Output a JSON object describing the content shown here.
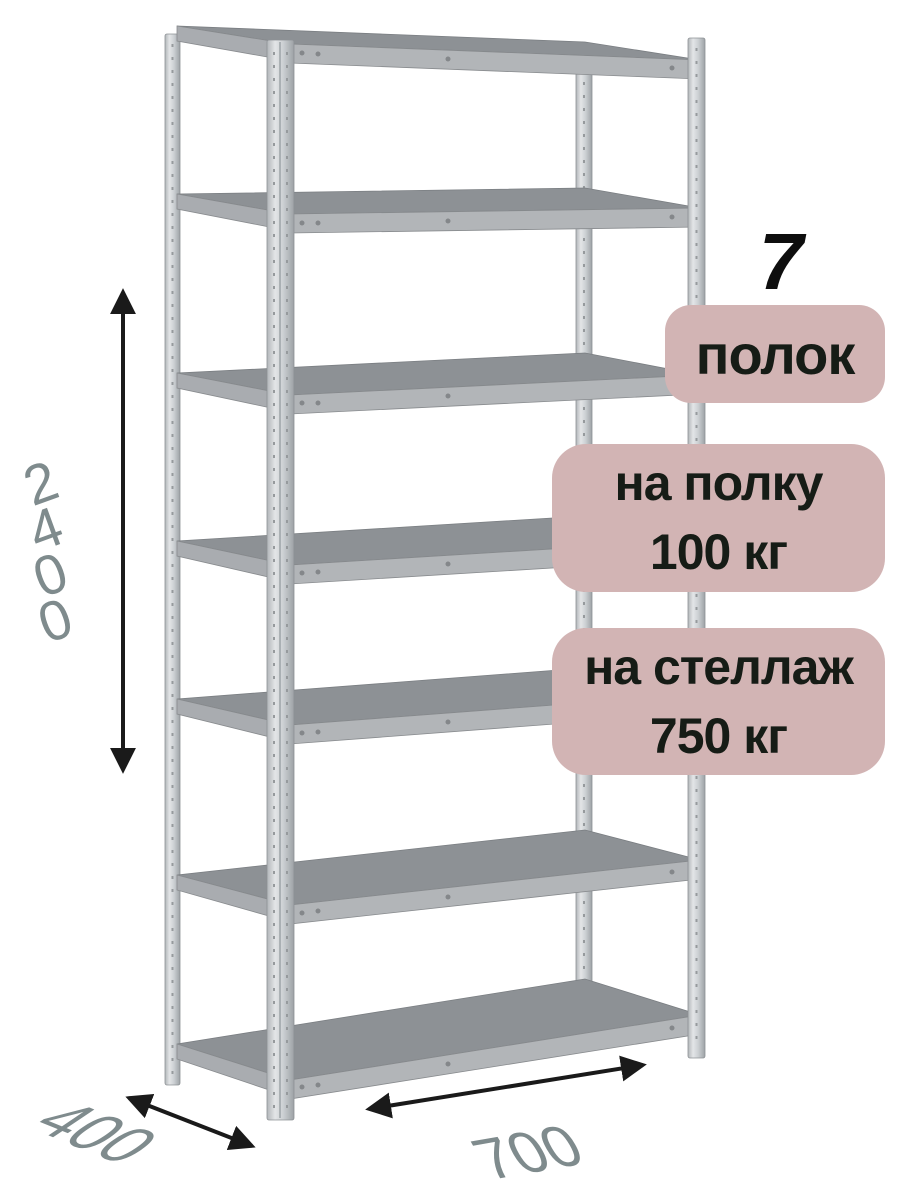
{
  "badges": {
    "shelf_count": {
      "number": "7",
      "label": "полок"
    },
    "per_shelf": {
      "line1": "на полку",
      "line2": "100 кг"
    },
    "per_rack": {
      "line1": "на стеллаж",
      "line2": "750 кг"
    }
  },
  "dimensions": {
    "height_mm": "2400",
    "depth_mm": "400",
    "width_mm": "700"
  },
  "figure": {
    "shelf_count": 7
  },
  "colors": {
    "badge_bg": "#d2b4b4",
    "badge_text": "#161c16",
    "dimension_text": "#7f8b8d",
    "arrow": "#1a1a1a",
    "shelf_top": "#8d9195",
    "shelf_edge": "#b2b5b8",
    "metal_light": "#d6d9db",
    "background": "#ffffff"
  }
}
